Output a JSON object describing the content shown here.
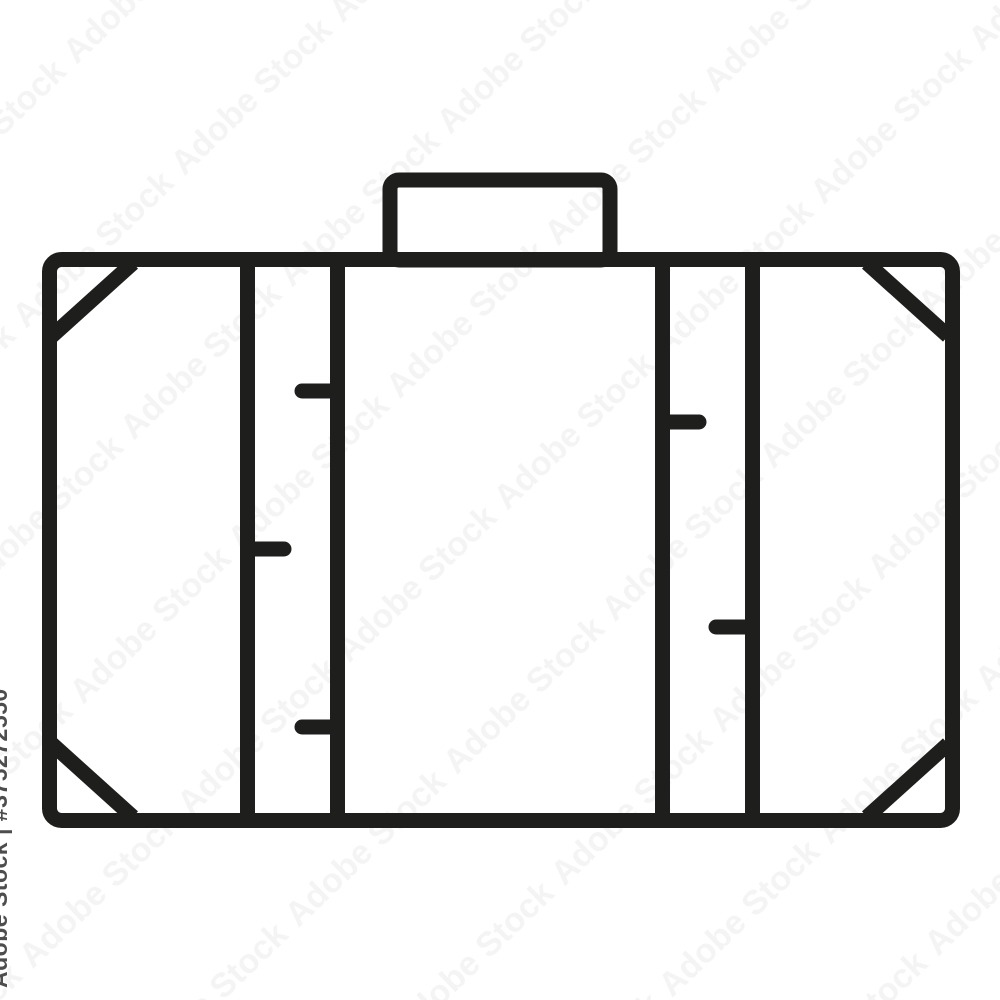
{
  "image": {
    "background_color": "#ffffff"
  },
  "icon": {
    "name": "suitcase-icon",
    "stroke_color": "#1e1e1c"
  },
  "watermark": {
    "side_text": "Adobe Stock | #375272550",
    "ghost_text": "Adobe Stock",
    "side_text_color": "#4d4d4d",
    "ghost_opacity": "0.045"
  }
}
